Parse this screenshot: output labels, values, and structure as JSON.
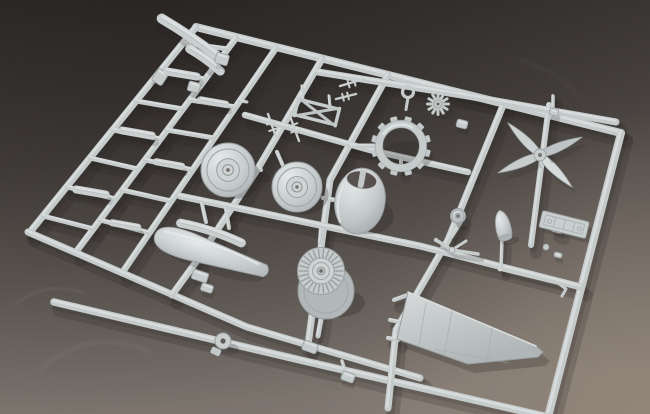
{
  "scene": {
    "type": "photograph",
    "subject": "light-gray injection-molded plastic model aircraft sprue (parts runner)",
    "setting": "dark gray studio backdrop, soft diffuse light, lighter toward bottom right",
    "palette": {
      "background_top": "#332f2d",
      "background_mid": "#57514d",
      "background_bottom": "#837b74",
      "background_warm_corner": "#98897e",
      "plastic_base": "#c5cbcb",
      "plastic_light": "#e7ebeb",
      "plastic_dark": "#9aa0a2",
      "cast_shadow": "#272421",
      "recess_dark": "#56514e"
    },
    "visible_parts": [
      "four-blade propeller",
      "engine cowling",
      "radial engine",
      "cowl cooling ring",
      "two main wheels",
      "small tail wheel",
      "wing panel",
      "drop-tank fairing halves",
      "landing-gear struts",
      "instrument panel",
      "propeller spinner",
      "antenna masts",
      "gun-sight frame",
      "many small flat detail parts on ladder runners"
    ]
  },
  "sprue": {
    "rails": [
      {
        "name": "frame-top-rail",
        "w": 8,
        "pts": [
          [
            196,
            27
          ],
          [
            621,
            133
          ]
        ]
      },
      {
        "name": "frame-right-rail",
        "w": 8,
        "pts": [
          [
            621,
            133
          ],
          [
            549,
            413
          ]
        ]
      },
      {
        "name": "ladder-rail-left",
        "w": 7,
        "pts": [
          [
            196,
            27
          ],
          [
            30,
            232
          ]
        ]
      },
      {
        "name": "ladder-rail-mid",
        "w": 6.5,
        "pts": [
          [
            236,
            38
          ],
          [
            76,
            252
          ]
        ]
      },
      {
        "name": "ladder-rail-right",
        "w": 6.5,
        "pts": [
          [
            276,
            48
          ],
          [
            122,
            273
          ]
        ]
      },
      {
        "name": "bottom-diagonal-rail",
        "w": 7,
        "pts": [
          [
            28,
            232
          ],
          [
            247,
            327
          ],
          [
            420,
            378
          ]
        ]
      },
      {
        "name": "bottom-long-rail",
        "w": 7.5,
        "pts": [
          [
            54,
            302
          ],
          [
            300,
            360
          ],
          [
            548,
            417
          ]
        ]
      },
      {
        "name": "runner-vertical-2",
        "w": 7,
        "pts": [
          [
            322,
            59
          ],
          [
            257,
            170
          ],
          [
            196,
            262
          ],
          [
            172,
            295
          ]
        ]
      },
      {
        "name": "runner-vertical-3",
        "w": 7,
        "pts": [
          [
            388,
            75
          ],
          [
            330,
            180
          ],
          [
            308,
            345
          ]
        ]
      },
      {
        "name": "runner-vertical-4",
        "w": 7,
        "pts": [
          [
            504,
            103
          ],
          [
            448,
            240
          ],
          [
            396,
            330
          ],
          [
            388,
            408
          ]
        ]
      },
      {
        "name": "runner-vertical-prop",
        "w": 6,
        "pts": [
          [
            549,
            105
          ],
          [
            531,
            245
          ]
        ]
      },
      {
        "name": "runner-horizontal-1",
        "w": 7,
        "pts": [
          [
            318,
            72
          ],
          [
            468,
            96
          ],
          [
            616,
            122
          ]
        ]
      },
      {
        "name": "runner-horizontal-2",
        "w": 6.5,
        "pts": [
          [
            245,
            115
          ],
          [
            370,
            150
          ],
          [
            468,
            172
          ]
        ]
      },
      {
        "name": "runner-horizontal-3",
        "w": 7,
        "pts": [
          [
            180,
            196
          ],
          [
            420,
            246
          ],
          [
            581,
            287
          ]
        ]
      }
    ],
    "rungs": [
      {
        "w": 5,
        "pts": [
          [
            183,
            43
          ],
          [
            228,
            49
          ]
        ]
      },
      {
        "w": 5,
        "pts": [
          [
            159,
            72
          ],
          [
            205,
            79
          ]
        ]
      },
      {
        "w": 5,
        "pts": [
          [
            136,
            101
          ],
          [
            183,
            109
          ]
        ]
      },
      {
        "w": 5,
        "pts": [
          [
            113,
            130
          ],
          [
            161,
            139
          ]
        ]
      },
      {
        "w": 5,
        "pts": [
          [
            90,
            158
          ],
          [
            138,
            169
          ]
        ]
      },
      {
        "w": 5,
        "pts": [
          [
            67,
            187
          ],
          [
            116,
            199
          ]
        ]
      },
      {
        "w": 5,
        "pts": [
          [
            43,
            216
          ],
          [
            94,
            229
          ]
        ]
      },
      {
        "w": 5,
        "pts": [
          [
            190,
            100
          ],
          [
            236,
            107
          ]
        ]
      },
      {
        "w": 5,
        "pts": [
          [
            167,
            130
          ],
          [
            214,
            138
          ]
        ]
      },
      {
        "w": 5,
        "pts": [
          [
            145,
            160
          ],
          [
            193,
            170
          ]
        ]
      },
      {
        "w": 5,
        "pts": [
          [
            122,
            190
          ],
          [
            171,
            201
          ]
        ]
      },
      {
        "w": 5,
        "pts": [
          [
            100,
            220
          ],
          [
            150,
            233
          ]
        ]
      }
    ],
    "stubs": [
      {
        "w": 4,
        "pts": [
          [
            250,
            167
          ],
          [
            261,
            170
          ]
        ]
      },
      {
        "w": 4,
        "pts": [
          [
            284,
            168
          ],
          [
            277,
            152
          ]
        ]
      },
      {
        "w": 4.5,
        "pts": [
          [
            335,
            200
          ],
          [
            323,
            198
          ]
        ]
      },
      {
        "w": 4.5,
        "pts": [
          [
            320,
            243
          ],
          [
            321,
            230
          ]
        ]
      },
      {
        "w": 5,
        "pts": [
          [
            322,
            314
          ],
          [
            318,
            336
          ]
        ]
      },
      {
        "w": 5,
        "pts": [
          [
            374,
            146
          ],
          [
            352,
            146
          ]
        ]
      },
      {
        "w": 4,
        "pts": [
          [
            401,
            170
          ],
          [
            401,
            160
          ]
        ]
      },
      {
        "w": 3.5,
        "pts": [
          [
            502,
            240
          ],
          [
            501,
            268
          ]
        ]
      },
      {
        "w": 3,
        "pts": [
          [
            461,
            223
          ],
          [
            452,
            237
          ]
        ]
      },
      {
        "w": 3.5,
        "pts": [
          [
            560,
            232
          ],
          [
            553,
            230
          ]
        ]
      },
      {
        "w": 4,
        "pts": [
          [
            394,
            300
          ],
          [
            408,
            295
          ]
        ]
      },
      {
        "w": 4,
        "pts": [
          [
            390,
            320
          ],
          [
            400,
            322
          ]
        ]
      },
      {
        "w": 4,
        "pts": [
          [
            388,
            338
          ],
          [
            398,
            340
          ]
        ]
      },
      {
        "w": 4,
        "pts": [
          [
            202,
            204
          ],
          [
            206,
            222
          ]
        ]
      },
      {
        "w": 4,
        "pts": [
          [
            226,
            209
          ],
          [
            229,
            228
          ]
        ]
      },
      {
        "w": 3,
        "pts": [
          [
            303,
            100
          ],
          [
            302,
            86
          ]
        ]
      },
      {
        "w": 3,
        "pts": [
          [
            330,
            106
          ],
          [
            329,
            96
          ]
        ]
      },
      {
        "w": 3,
        "pts": [
          [
            247,
            102
          ],
          [
            239,
            101
          ]
        ]
      },
      {
        "w": 3.5,
        "pts": [
          [
            345,
            370
          ],
          [
            342,
            361
          ]
        ]
      },
      {
        "w": 3.5,
        "pts": [
          [
            553,
            96
          ],
          [
            553,
            108
          ]
        ]
      }
    ]
  },
  "parts": [
    {
      "type": "strip",
      "name": "fuselage-strip-1",
      "cx": 189,
      "cy": 37,
      "len": 66,
      "w": 10,
      "rot": 34,
      "bow": 2
    },
    {
      "type": "strip",
      "name": "fuselage-strip-2",
      "cx": 205,
      "cy": 60,
      "len": 38,
      "w": 9,
      "rot": 36,
      "bow": 2
    },
    {
      "type": "clip",
      "name": "small-clip",
      "cx": 160,
      "cy": 77,
      "w": 12,
      "h": 14,
      "rot": 34
    },
    {
      "type": "strip",
      "name": "ladder-part-1",
      "cx": 182,
      "cy": 74,
      "len": 30,
      "w": 8,
      "rot": 10,
      "bow": 0
    },
    {
      "type": "strip",
      "name": "ladder-part-2",
      "cx": 137,
      "cy": 133,
      "len": 30,
      "w": 8,
      "rot": 10,
      "bow": 0
    },
    {
      "type": "strip",
      "name": "ladder-part-3",
      "cx": 91,
      "cy": 192,
      "len": 30,
      "w": 8,
      "rot": 10,
      "bow": 0
    },
    {
      "type": "strip",
      "name": "ladder-part-4",
      "cx": 213,
      "cy": 102,
      "len": 26,
      "w": 7,
      "rot": 10,
      "bow": 0
    },
    {
      "type": "strip",
      "name": "ladder-part-5",
      "cx": 169,
      "cy": 164,
      "len": 26,
      "w": 7,
      "rot": 10,
      "bow": 0
    },
    {
      "type": "strip",
      "name": "ladder-part-6",
      "cx": 125,
      "cy": 225,
      "len": 26,
      "w": 7,
      "rot": 10,
      "bow": 0
    },
    {
      "type": "clip",
      "name": "ladder-clip-1",
      "cx": 222,
      "cy": 59,
      "w": 13,
      "h": 11,
      "rot": 16
    },
    {
      "type": "clip",
      "name": "ladder-clip-2",
      "cx": 194,
      "cy": 87,
      "w": 12,
      "h": 10,
      "rot": 16
    },
    {
      "type": "wheel",
      "name": "main-wheel-1",
      "cx": 228,
      "cy": 170,
      "r": 27
    },
    {
      "type": "wheel",
      "name": "main-wheel-2",
      "cx": 297,
      "cy": 187,
      "r": 25
    },
    {
      "type": "strip",
      "name": "fairing-strip",
      "cx": 211,
      "cy": 233,
      "len": 64,
      "w": 9,
      "rot": 18,
      "bow": 4
    },
    {
      "type": "pod",
      "name": "drop-tank-half",
      "cx": 210,
      "cy": 253,
      "len": 58,
      "w": 22,
      "rot": 18
    },
    {
      "type": "clip",
      "name": "step-bracket-1",
      "cx": 200,
      "cy": 276,
      "w": 16,
      "h": 10,
      "rot": 18
    },
    {
      "type": "clip",
      "name": "step-bracket-2",
      "cx": 207,
      "cy": 288,
      "w": 12,
      "h": 8,
      "rot": 18
    },
    {
      "type": "cowling",
      "name": "engine-cowling",
      "cx": 360,
      "cy": 201,
      "rot": 10
    },
    {
      "type": "engine",
      "name": "radial-engine",
      "cx": 321,
      "cy": 271
    },
    {
      "type": "cog",
      "name": "cowl-flap-ring",
      "cx": 401,
      "cy": 146,
      "r": 22
    },
    {
      "type": "stargear",
      "name": "small-gear",
      "cx": 438,
      "cy": 104,
      "r": 10.5
    },
    {
      "type": "ringpart",
      "name": "small-ring-part",
      "cx": 408,
      "cy": 92,
      "r": 5.5
    },
    {
      "type": "xframe",
      "name": "gunsight-frame",
      "cx": 317,
      "cy": 112,
      "rot": 14
    },
    {
      "type": "antenna",
      "name": "antenna-mast-1",
      "pts": [
        [
          268,
          114
        ],
        [
          277,
          140
        ]
      ],
      "tick": 9
    },
    {
      "type": "antenna",
      "name": "antenna-mast-2",
      "pts": [
        [
          290,
          116
        ],
        [
          299,
          141
        ]
      ],
      "tick": 9
    },
    {
      "type": "antenna",
      "name": "antenna-mast-3",
      "pts": [
        [
          340,
          86
        ],
        [
          364,
          79
        ]
      ],
      "tick": 8
    },
    {
      "type": "antenna",
      "name": "antenna-mast-4",
      "pts": [
        [
          336,
          99
        ],
        [
          356,
          94
        ]
      ],
      "tick": 7
    },
    {
      "type": "prop",
      "name": "four-blade-propeller",
      "cx": 540,
      "cy": 155,
      "len": 46,
      "angles": [
        225,
        45,
        -23,
        157
      ]
    },
    {
      "type": "cone",
      "name": "propeller-spinner",
      "cx": 503,
      "cy": 226,
      "rot": -12
    },
    {
      "type": "wheel",
      "name": "tail-wheel",
      "cx": 458,
      "cy": 216,
      "r": 7.5
    },
    {
      "type": "panel",
      "name": "instrument-panel",
      "cx": 564,
      "cy": 225,
      "rot": 14
    },
    {
      "type": "ystrut",
      "name": "gear-strut-y",
      "main": [
        [
          436,
          240
        ],
        [
          452,
          250
        ],
        [
          478,
          254
        ]
      ],
      "branch": [
        [
          452,
          250
        ],
        [
          466,
          241
        ]
      ]
    },
    {
      "type": "strut",
      "name": "gear-strut-long",
      "main": [
        [
          500,
          269
        ],
        [
          558,
          283
        ]
      ],
      "foot": [
        [
          558,
          283
        ],
        [
          566,
          289
        ],
        [
          562,
          296
        ]
      ]
    },
    {
      "type": "dot",
      "name": "small-round-part",
      "cx": 546,
      "cy": 247,
      "r": 3
    },
    {
      "type": "clip",
      "name": "tiny-part-1",
      "cx": 558,
      "cy": 255,
      "w": 8,
      "h": 5,
      "rot": 15
    },
    {
      "type": "clip",
      "name": "tiny-part-2",
      "cx": 462,
      "cy": 124,
      "w": 11,
      "h": 8,
      "rot": 15
    },
    {
      "type": "clip",
      "name": "tiny-part-3",
      "cx": 554,
      "cy": 112,
      "w": 9,
      "h": 7,
      "rot": 15
    },
    {
      "type": "wing",
      "name": "wing-panel",
      "outline": [
        [
          408,
          292
        ],
        [
          536,
          346
        ],
        [
          543,
          352
        ],
        [
          538,
          357
        ],
        [
          468,
          364
        ],
        [
          397,
          339
        ]
      ],
      "edge": [
        [
          408,
          292
        ],
        [
          536,
          346
        ]
      ],
      "lines": [
        [
          [
            452,
            311
          ],
          [
            444,
            356
          ]
        ],
        [
          [
            492,
            328
          ],
          [
            487,
            361
          ]
        ],
        [
          [
            426,
            303
          ],
          [
            419,
            345
          ]
        ]
      ]
    },
    {
      "type": "grommet",
      "name": "hub-part",
      "cx": 223,
      "cy": 341,
      "r": 8
    },
    {
      "type": "clip",
      "name": "small-bracket",
      "cx": 310,
      "cy": 347,
      "w": 15,
      "h": 10,
      "rot": 20
    },
    {
      "type": "clip",
      "name": "small-part-bottom",
      "cx": 348,
      "cy": 377,
      "w": 13,
      "h": 9,
      "rot": 20
    }
  ]
}
